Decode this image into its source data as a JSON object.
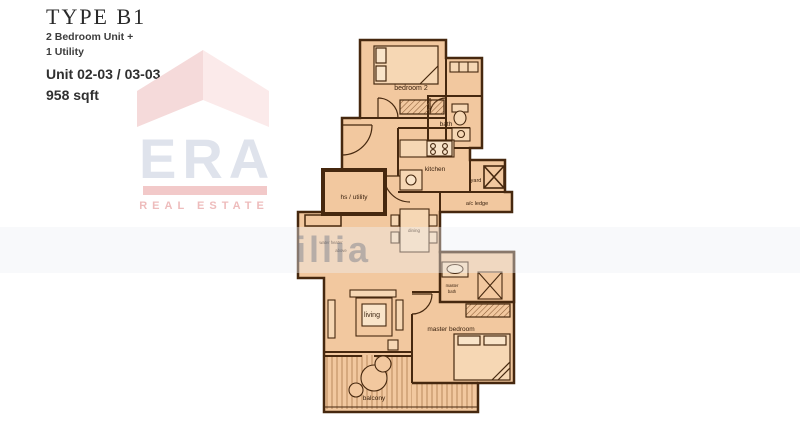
{
  "header": {
    "type_title": "TYPE B1",
    "subtitle_line1": "2 Bedroom Unit +",
    "subtitle_line2": "1 Utility",
    "unit_line": "Unit 02-03 / 03-03",
    "area_line": "958 sqft"
  },
  "logo": {
    "name": "ERA",
    "tagline": "REAL ESTATE"
  },
  "watermark": {
    "fragment": "illia"
  },
  "floorplan": {
    "labels": {
      "bedroom2": "bedroom 2",
      "bath": "bath",
      "kitchen": "kitchen",
      "yard": "yard",
      "ac_ledge": "a/c ledge",
      "hs_utility": "hs / utility",
      "dining": "dining",
      "note_line1": "water heater",
      "note_line2": "above",
      "living": "living",
      "master_bath_line1": "master",
      "master_bath_line2": "bath",
      "master_bedroom": "master bedroom",
      "balcony": "balcony"
    },
    "colors": {
      "plan_fill": "#f2c89f",
      "fixture_fill": "#f6d7b4",
      "wall": "#46280f",
      "label_text": "#3b2310",
      "deck_line": "#b98a5e",
      "hatch_line": "#8a5c34",
      "era_pink": "#f2c9c9",
      "era_gray": "#dfe3ec"
    }
  }
}
